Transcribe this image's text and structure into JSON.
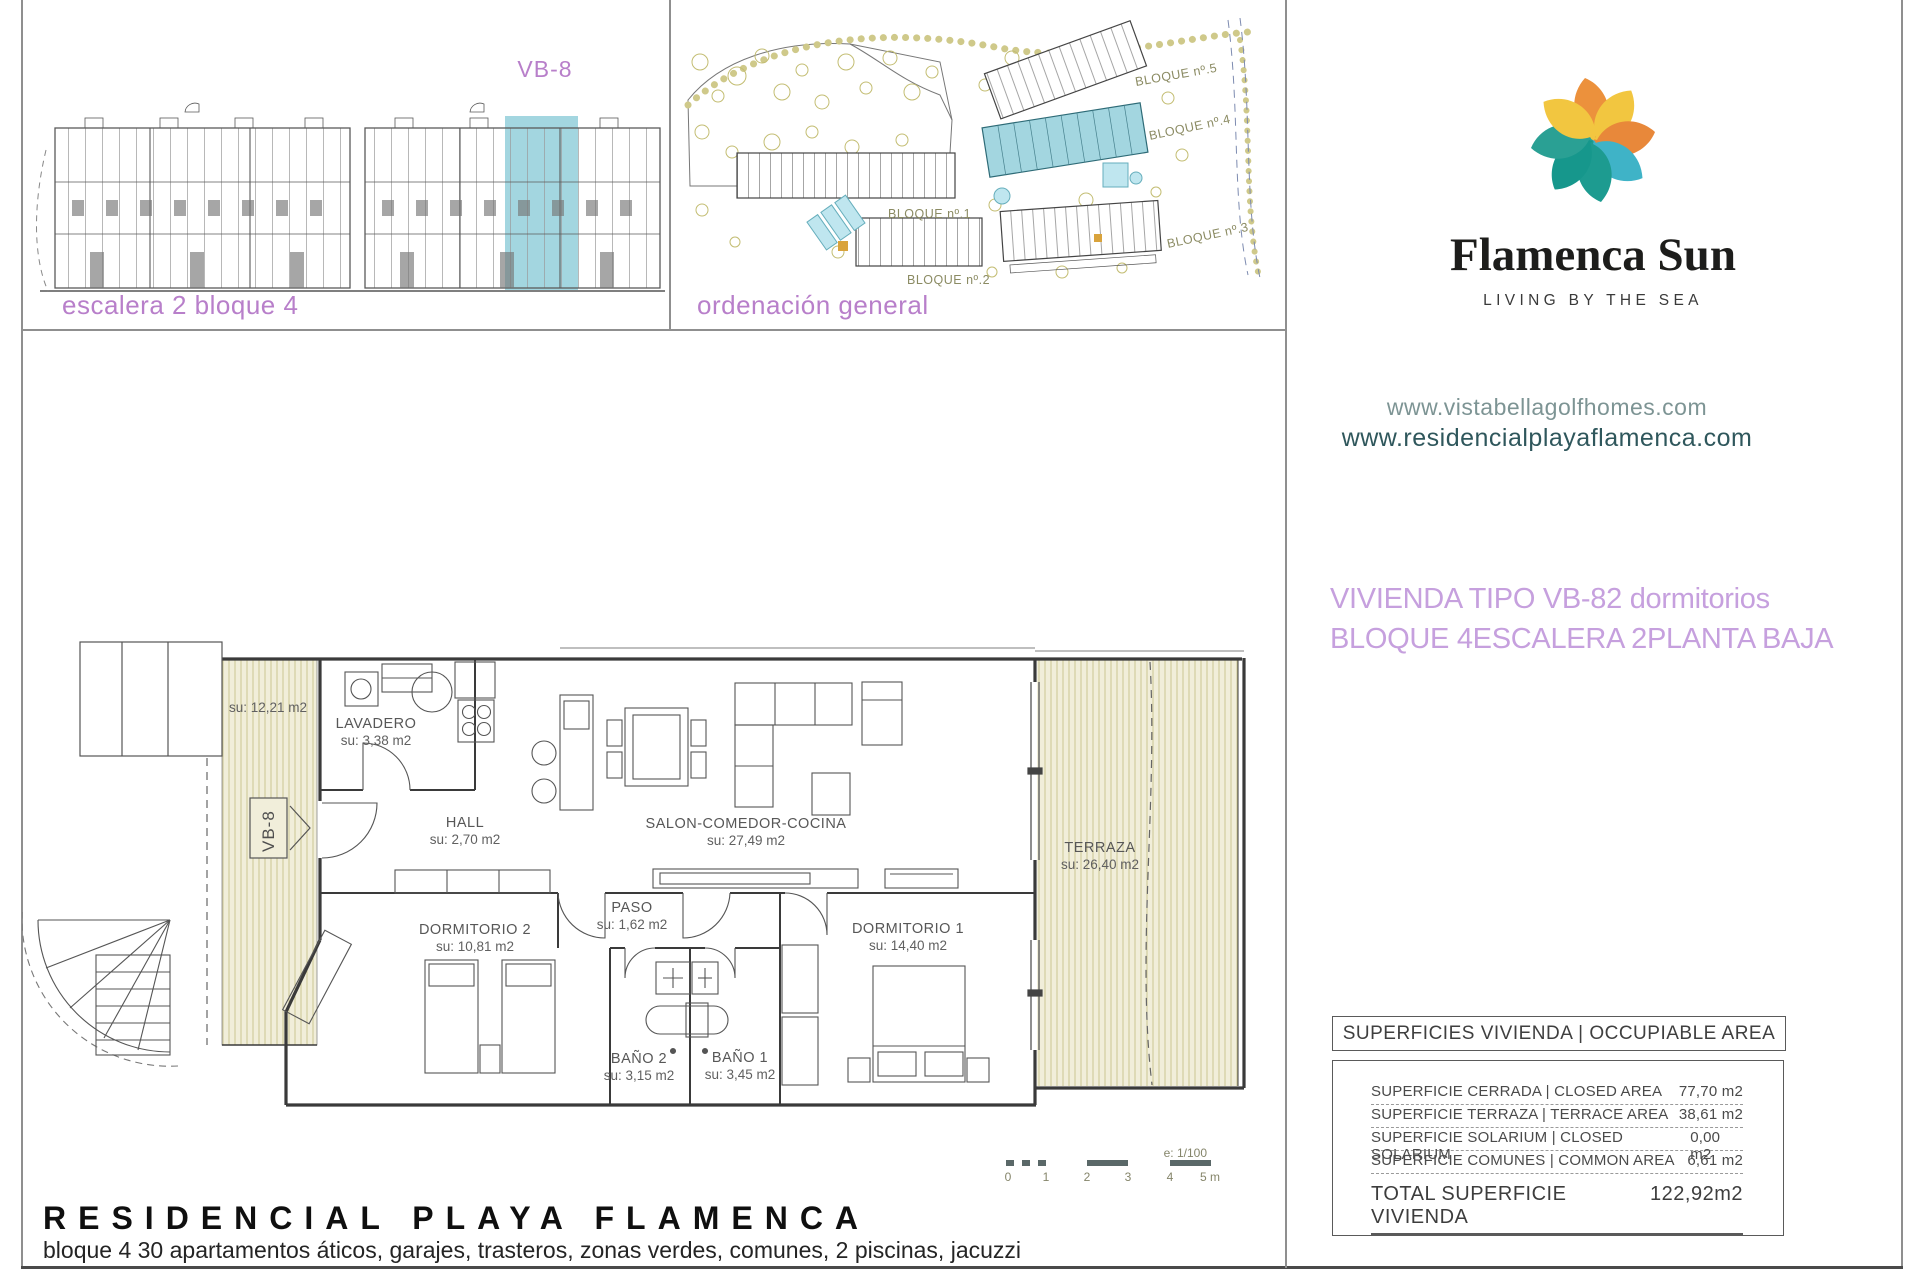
{
  "colors": {
    "purple_caption": "#b87fca",
    "violet_unit_info": "#c6a0de",
    "teal_highlight": "#a3d6e0",
    "website_1": "#7d9494",
    "website_2": "#2f575c",
    "logo_orange": "#ec913c",
    "logo_yellow": "#f2c640",
    "logo_teal": "#1d9b90",
    "logo_blue": "#3fb3c7",
    "hatch_bg": "#f1eeda",
    "hatch_line": "#ccc593"
  },
  "elevation_panel": {
    "unit_label": "VB-8",
    "caption": "escalera 2 bloque 4"
  },
  "siteplan_panel": {
    "caption": "ordenación general",
    "block_labels": [
      "BLOQUE nº.1",
      "BLOQUE nº.2",
      "BLOQUE nº.3",
      "BLOQUE nº.4",
      "BLOQUE nº.5"
    ]
  },
  "branding": {
    "logo_text": "Flamenca Sun",
    "tagline": "LIVING BY THE SEA",
    "website_1": "www.vistabellagolfhomes.com",
    "website_2": "www.residencialplayaflamenca.com"
  },
  "unit_info": {
    "line1_left": "VIVIENDA TIPO VB-8",
    "line1_right": "2 dormitorios",
    "line2_a": "BLOQUE 4",
    "line2_b": "ESCALERA 2",
    "line2_c": "PLANTA BAJA"
  },
  "floorplan": {
    "unit_tag": "VB-8",
    "rooms": {
      "terraza_izq": {
        "area": "su: 12,21 m2"
      },
      "lavadero": {
        "name": "LAVADERO",
        "area": "su: 3,38 m2"
      },
      "hall": {
        "name": "HALL",
        "area": "su: 2,70 m2"
      },
      "salon": {
        "name": "SALON-COMEDOR-COCINA",
        "area": "su: 27,49 m2"
      },
      "terraza": {
        "name": "TERRAZA",
        "area": "su: 26,40 m2"
      },
      "paso": {
        "name": "PASO",
        "area": "su: 1,62 m2"
      },
      "dormitorio2": {
        "name": "DORMITORIO 2",
        "area": "su: 10,81 m2"
      },
      "dormitorio1": {
        "name": "DORMITORIO 1",
        "area": "su: 14,40 m2"
      },
      "bano2": {
        "name": "BAÑO 2",
        "area": "su: 3,15 m2"
      },
      "bano1": {
        "name": "BAÑO 1",
        "area": "su: 3,45 m2"
      }
    },
    "scale": {
      "label": "e: 1/100",
      "ticks": [
        "0",
        "1",
        "2",
        "3",
        "4",
        "5 m"
      ]
    }
  },
  "areas_table": {
    "header": "SUPERFICIES VIVIENDA | OCCUPIABLE AREA",
    "rows": [
      {
        "label": "SUPERFICIE CERRADA | CLOSED AREA",
        "value": "77,70 m2"
      },
      {
        "label": "SUPERFICIE TERRAZA | TERRACE AREA",
        "value": "38,61 m2"
      },
      {
        "label": "SUPERFICIE SOLARIUM | CLOSED SOLARIUM",
        "value": "0,00 m2"
      },
      {
        "label": "SUPERFICIE COMUNES | COMMON AREA",
        "value": "6,61 m2"
      }
    ],
    "total_label": "TOTAL SUPERFICIE VIVIENDA",
    "total_value": "122,92m2"
  },
  "footer": {
    "title": "RESIDENCIAL PLAYA FLAMENCA",
    "subtitle": "bloque 4 30 apartamentos áticos, garajes, trasteros, zonas verdes, comunes, 2 piscinas, jacuzzi"
  }
}
